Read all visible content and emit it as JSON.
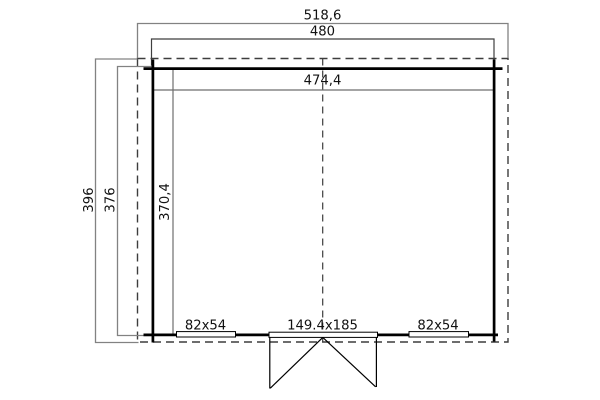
{
  "drawing": {
    "type": "floor-plan",
    "dims": {
      "roof_width": "518,6",
      "outer_width": "480",
      "inner_width": "474,4",
      "roof_depth": "396",
      "outer_depth": "376",
      "inner_depth": "370,4"
    },
    "openings": {
      "left_window": "82x54",
      "door": "149.4x185",
      "right_window": "82x54"
    },
    "colors": {
      "bg": "#ffffff",
      "wall": "#000000",
      "text": "#111111",
      "dash": "#3d3d3d",
      "dim_light": "#828282",
      "dim_dark": "#3f3f3f",
      "dim_inner": "#6e6e6e"
    }
  }
}
